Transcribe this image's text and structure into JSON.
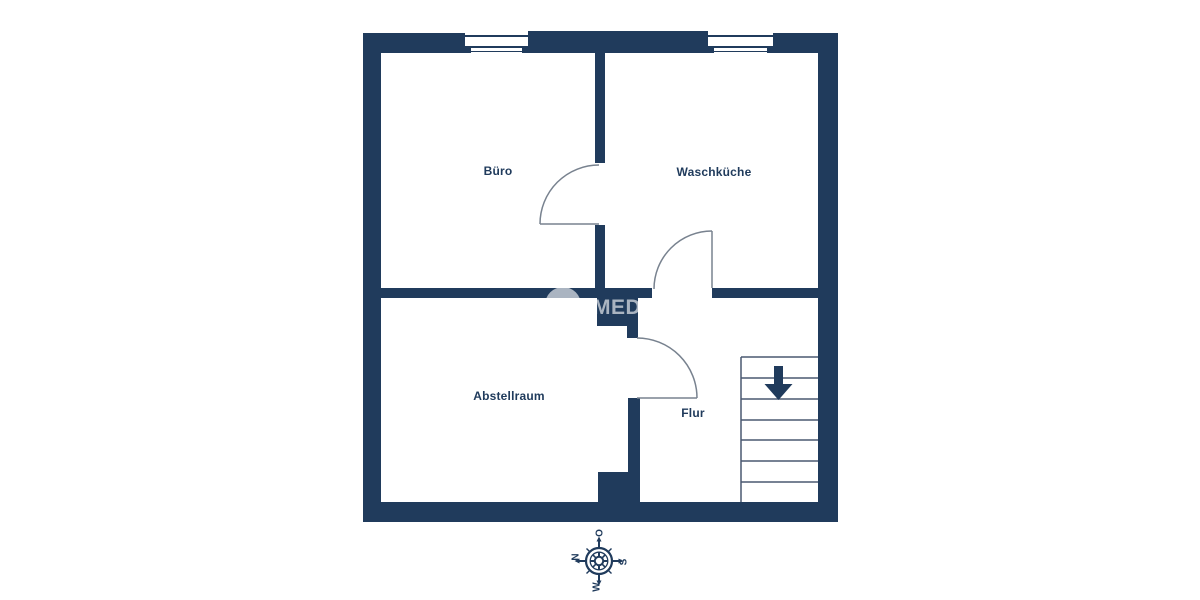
{
  "plan": {
    "rooms": [
      {
        "name": "Büro"
      },
      {
        "name": "Waschküche"
      },
      {
        "name": "Abstellraum"
      },
      {
        "name": "Flur"
      }
    ],
    "stairs": {
      "treads": 7,
      "direction": "down"
    },
    "windows": 2,
    "doors": 3
  },
  "compass": {
    "top": "O",
    "left": "N",
    "right": "S",
    "bottom": "W"
  },
  "watermark": {
    "text": "MED"
  },
  "colors": {
    "wall": "#203b5c",
    "door_line": "#78828f",
    "stair_line": "#4a5870",
    "label_text": "#203b5c",
    "watermark_tint": "rgba(255,255,255,0.62)"
  }
}
